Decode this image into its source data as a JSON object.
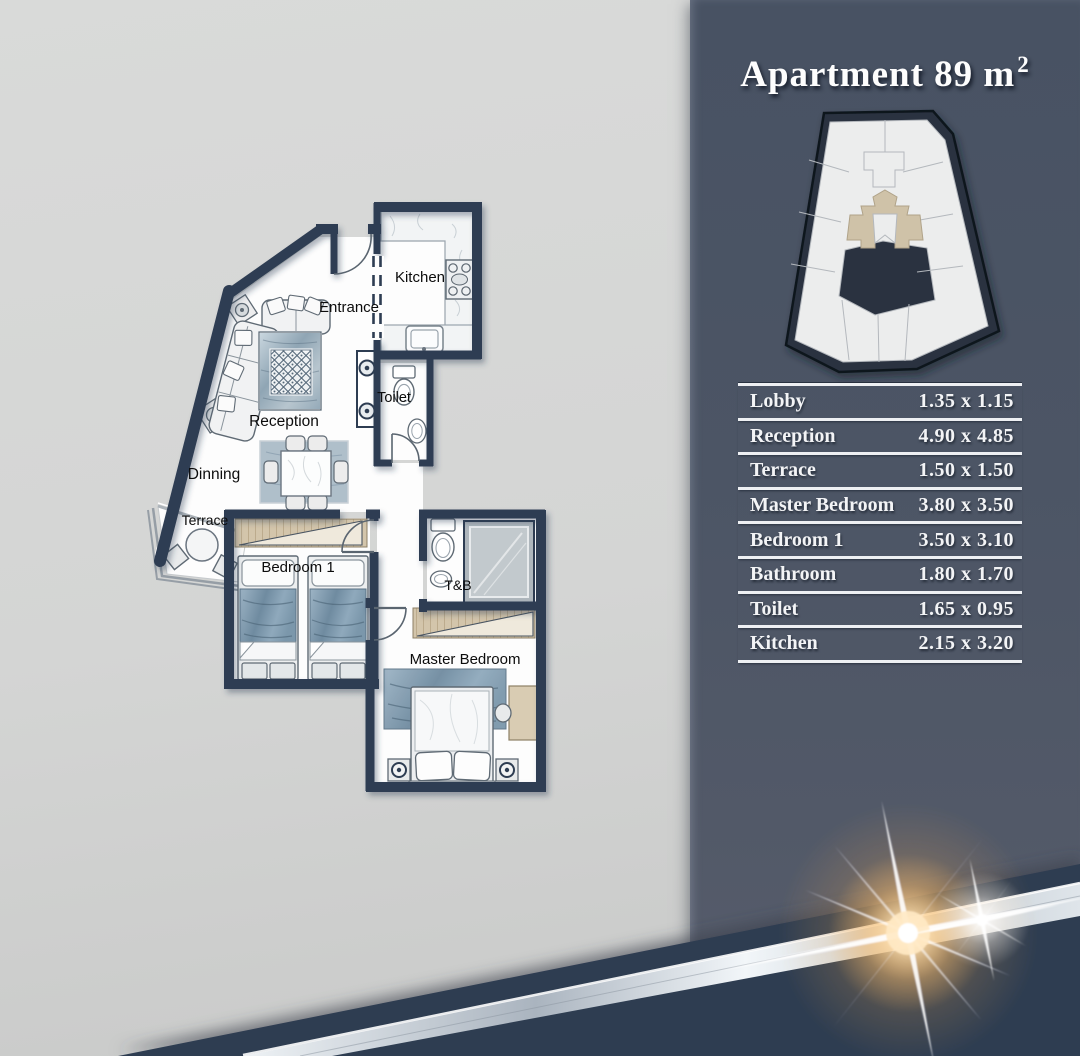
{
  "sidebar": {
    "title": {
      "text": "Apartment 89 m",
      "sup": "2"
    },
    "table": {
      "rows": [
        {
          "label": "Lobby",
          "size": "1.35 x 1.15"
        },
        {
          "label": "Reception",
          "size": "4.90 x 4.85"
        },
        {
          "label": "Terrace",
          "size": "1.50 x 1.50"
        },
        {
          "label": "Master Bedroom",
          "size": "3.80 x 3.50"
        },
        {
          "label": "Bedroom 1",
          "size": "3.50 x 3.10"
        },
        {
          "label": "Bathroom",
          "size": "1.80 x 1.70"
        },
        {
          "label": "Toilet",
          "size": "1.65 x 0.95"
        },
        {
          "label": "Kitchen",
          "size": "2.15 x 3.20"
        }
      ]
    }
  },
  "floorplan": {
    "rooms": [
      {
        "id": "kitchen",
        "label": "Kitchen"
      },
      {
        "id": "entrance",
        "label": "Entrance"
      },
      {
        "id": "toilet",
        "label": "Toilet"
      },
      {
        "id": "reception",
        "label": "Reception"
      },
      {
        "id": "dinning",
        "label": "Dinning"
      },
      {
        "id": "terrace",
        "label": "Terrace"
      },
      {
        "id": "bedroom1",
        "label": "Bedroom 1"
      },
      {
        "id": "tb",
        "label": "T&B"
      },
      {
        "id": "master",
        "label": "Master Bedroom"
      }
    ]
  },
  "colors": {
    "sidebar": "#4c5565",
    "band_navy": "#2d3c51",
    "wall": "#2e3d52",
    "highlight_unit_tan": "#cfc2a8",
    "flare_gold": "#ffc66e"
  }
}
